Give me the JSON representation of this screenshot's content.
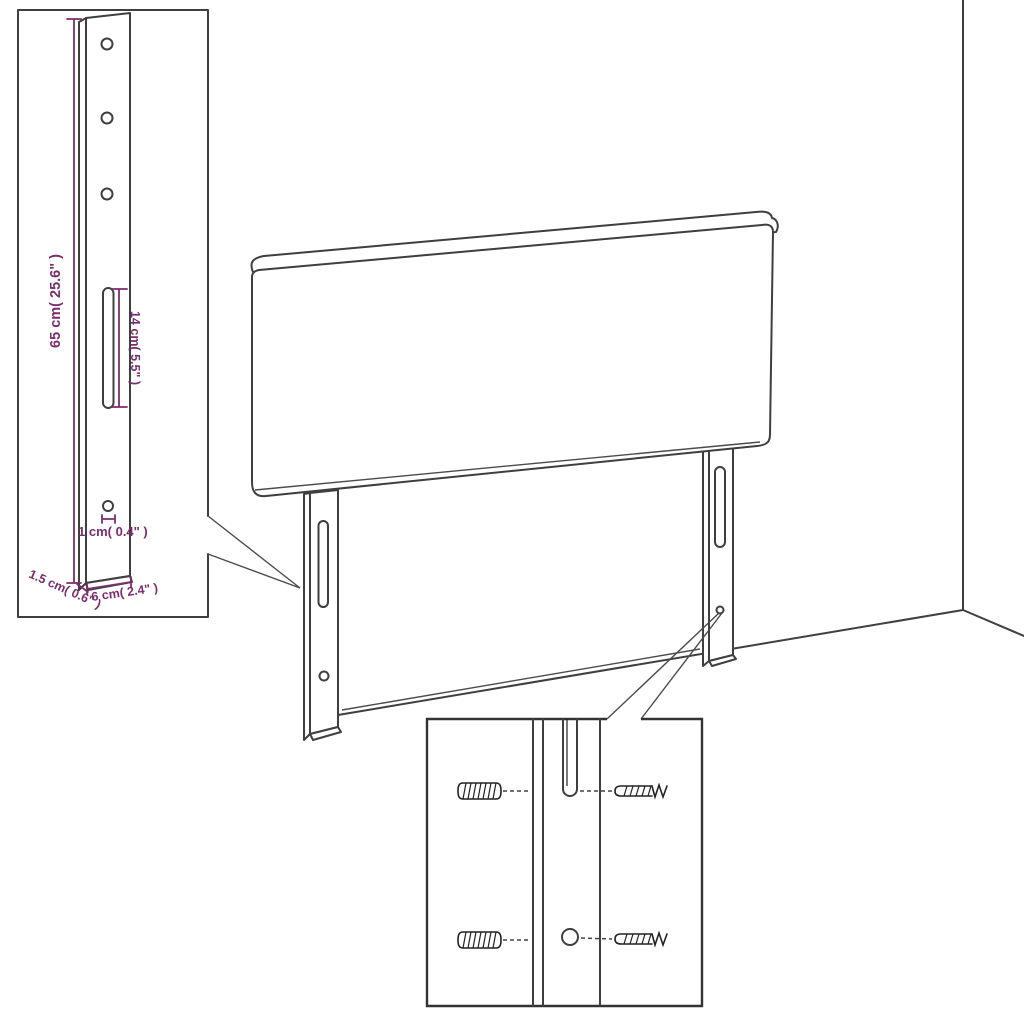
{
  "figure": {
    "kind": "product-dimension-diagram",
    "subject": "headboard-with-mounting-legs"
  },
  "dimensions": {
    "leg_height": {
      "label": "65 cm( 25.6\" )"
    },
    "slot_length": {
      "label": "14 cm( 5.5\" )"
    },
    "hole_size": {
      "label": "1 cm( 0.4\" )"
    },
    "leg_thickness": {
      "label": "1.5 cm( 0.6\" )"
    },
    "leg_width": {
      "label": "6 cm( 2.4\" )"
    }
  },
  "colors": {
    "outline": "#3f3f3f",
    "dimension": "#7b2d6d",
    "pointer": "#4b4b4b",
    "background": "#ffffff"
  }
}
